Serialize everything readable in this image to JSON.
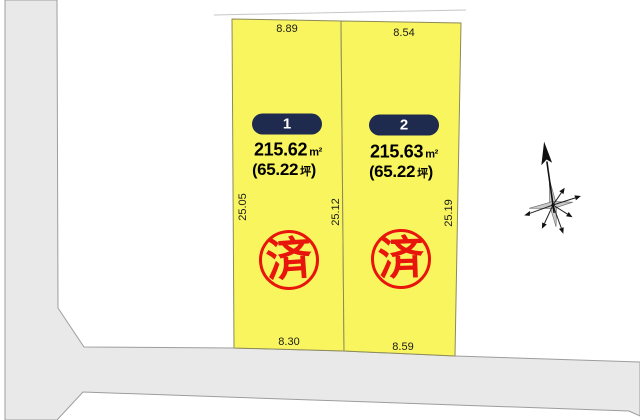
{
  "title": "land-plot-layout-diagram",
  "colors": {
    "plot_fill": "#f9f55f",
    "plot_border": "#8c8a5a",
    "road_fill": "#e9e9e9",
    "road_border": "#9d9d9d",
    "badge_bg": "#1e2a4e",
    "badge_text": "#ffffff",
    "stamp_red": "#e8150d",
    "dim_text": "#1b1b1b"
  },
  "plots": [
    {
      "number": "1",
      "area_value": "215.62",
      "area_unit": "m²",
      "tsubo_prefix": "(",
      "tsubo_value": "65.22",
      "tsubo_unit": "坪",
      "tsubo_suffix": ")",
      "dim_top": "8.89",
      "dim_bottom": "8.30",
      "dim_left": "25.05",
      "dim_right": "25.12",
      "stamp": "済"
    },
    {
      "number": "2",
      "area_value": "215.63",
      "area_unit": "m²",
      "tsubo_prefix": "(",
      "tsubo_value": "65.22",
      "tsubo_unit": "坪",
      "tsubo_suffix": ")",
      "dim_top": "8.54",
      "dim_bottom": "8.59",
      "dim_right": "25.19",
      "stamp": "済"
    }
  ]
}
